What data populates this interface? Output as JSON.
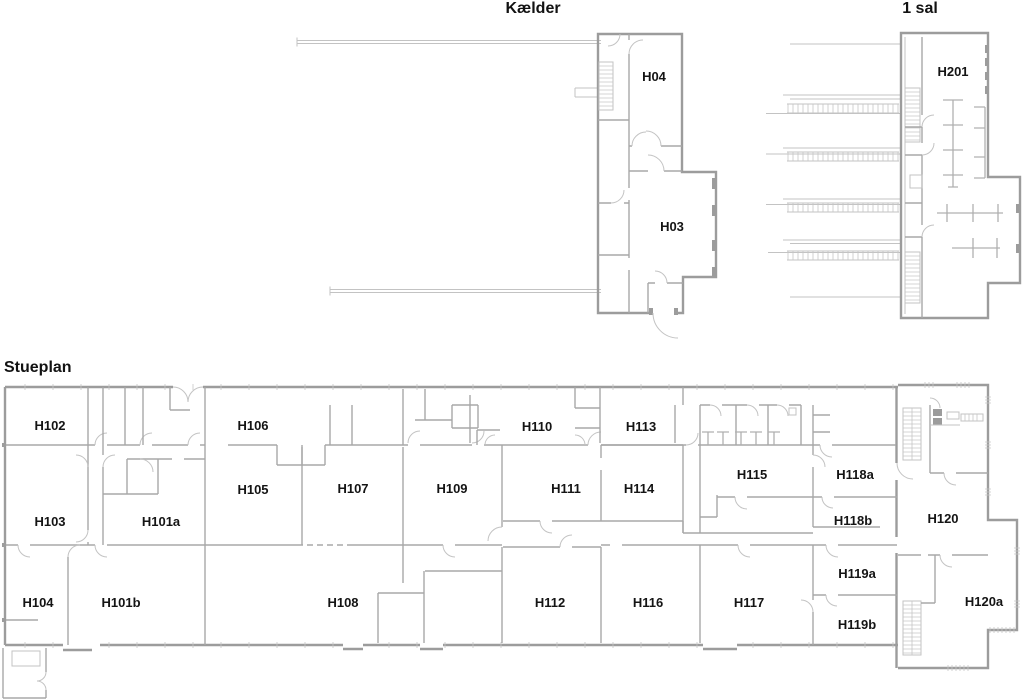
{
  "plans": {
    "kaelder": {
      "title": "Kælder",
      "rooms": [
        {
          "id": "H04",
          "label": "H04"
        },
        {
          "id": "H03",
          "label": "H03"
        }
      ]
    },
    "first_floor": {
      "title": "1 sal",
      "rooms": [
        {
          "id": "H201",
          "label": "H201"
        }
      ]
    },
    "ground_floor": {
      "title": "Stueplan",
      "rooms": [
        {
          "id": "H102",
          "label": "H102"
        },
        {
          "id": "H106",
          "label": "H106"
        },
        {
          "id": "H110",
          "label": "H110"
        },
        {
          "id": "H113",
          "label": "H113"
        },
        {
          "id": "H105",
          "label": "H105"
        },
        {
          "id": "H107",
          "label": "H107"
        },
        {
          "id": "H109",
          "label": "H109"
        },
        {
          "id": "H111",
          "label": "H111"
        },
        {
          "id": "H114",
          "label": "H114"
        },
        {
          "id": "H115",
          "label": "H115"
        },
        {
          "id": "H118a",
          "label": "H118a"
        },
        {
          "id": "H103",
          "label": "H103"
        },
        {
          "id": "H101a",
          "label": "H101a"
        },
        {
          "id": "H118b",
          "label": "H118b"
        },
        {
          "id": "H120",
          "label": "H120"
        },
        {
          "id": "H119a",
          "label": "H119a"
        },
        {
          "id": "H104",
          "label": "H104"
        },
        {
          "id": "H101b",
          "label": "H101b"
        },
        {
          "id": "H108",
          "label": "H108"
        },
        {
          "id": "H112",
          "label": "H112"
        },
        {
          "id": "H116",
          "label": "H116"
        },
        {
          "id": "H117",
          "label": "H117"
        },
        {
          "id": "H119b",
          "label": "H119b"
        },
        {
          "id": "H120a",
          "label": "H120a"
        }
      ]
    }
  },
  "colors": {
    "background": "#ffffff",
    "wall": "#9c9c9c",
    "wall_interior": "#a8a8a8",
    "thin_line": "#c3c3c3",
    "label_text": "#141414"
  }
}
